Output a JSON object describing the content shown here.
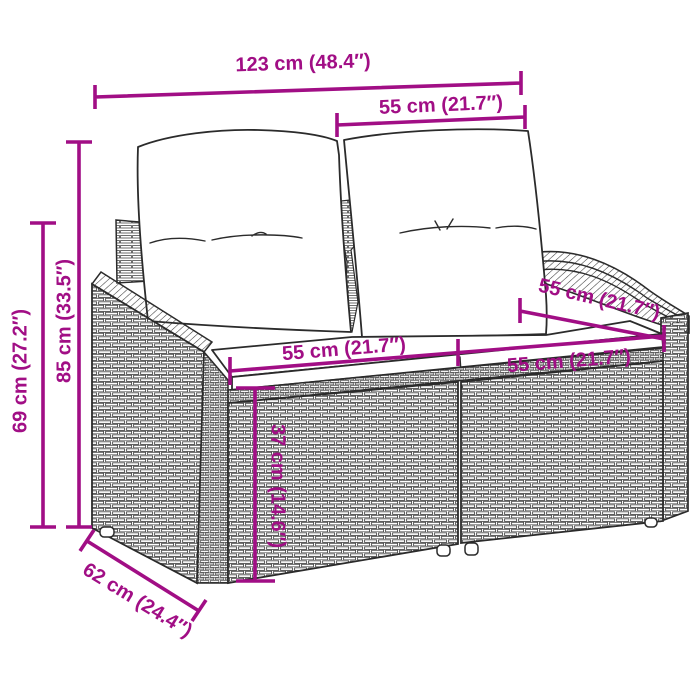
{
  "diagram": {
    "subject": "poly-rattan-2-seater-garden-sofa-with-cushions",
    "style": {
      "accent_color": "#A10E85",
      "line_color": "#2b2b2b",
      "background_color": "#ffffff"
    },
    "dims": {
      "total_width": "123 cm (48.4″)",
      "seat_section_top": "55 cm (21.7″)",
      "total_height": "85 cm (33.5″)",
      "armrest_height": "69 cm (27.2″)",
      "seat_width_left": "55 cm (21.7″)",
      "seat_width_right": "55 cm (21.7″)",
      "seat_depth": "55 cm (21.7″)",
      "seat_height": "37 cm (14.6″)",
      "total_depth": "62 cm (24.4″)"
    }
  }
}
